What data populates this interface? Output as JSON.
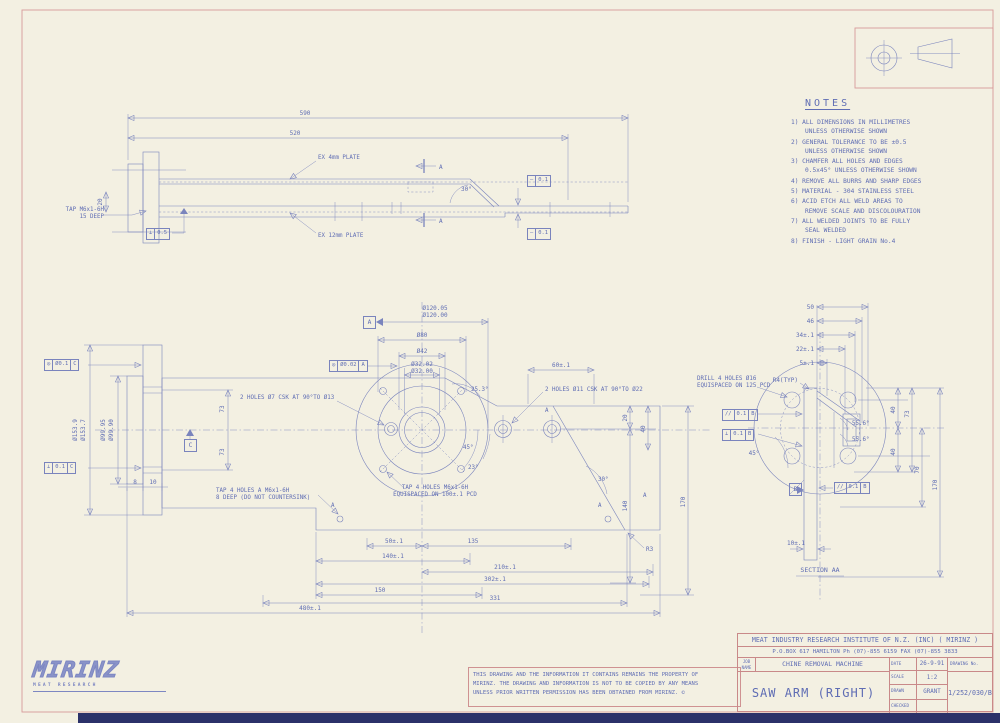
{
  "colors": {
    "paper": "#f3f0e2",
    "ink": "#7a84bd",
    "red": "#cf9292",
    "text": "#5f6db4",
    "dark_bar": "#2b3169"
  },
  "notes": {
    "title": "NOTES",
    "items": [
      "1) ALL DIMENSIONS IN MILLIMETRES\nUNLESS OTHERWISE SHOWN",
      "2) GENERAL TOLERANCE TO BE ±0.5\nUNLESS OTHERWISE SHOWN",
      "3) CHAMFER ALL HOLES AND EDGES\n0.5x45° UNLESS OTHERWISE SHOWN",
      "4) REMOVE ALL BURRS AND SHARP EDGES",
      "5) MATERIAL - 304 STAINLESS STEEL",
      "6) ACID ETCH ALL WELD AREAS TO\nREMOVE SCALE AND DISCOLOURATION",
      "7) ALL WELDED JOINTS TO BE FULLY\nSEAL WELDED",
      "8) FINISH - LIGHT GRAIN No.4"
    ]
  },
  "top_view": {
    "d590": "590",
    "d520": "520",
    "d20": "20",
    "ex4": "EX 4mm PLATE",
    "ex12": "EX 12mm PLATE",
    "tap": "TAP M6x1-6H\n15 DEEP",
    "sec_a1": "A",
    "sec_a2": "A",
    "ang30": "30°",
    "fcf_perp": {
      "sym": "⊥",
      "val": "0.5"
    },
    "fcf_str1": {
      "sym": "–",
      "val": "0.1"
    },
    "fcf_str2": {
      "sym": "–",
      "val": "0.1"
    }
  },
  "main_view": {
    "dia120_a": "Ø120.05",
    "dia120_b": "Ø120.00",
    "dia80": "Ø80",
    "dia42": "Ø42",
    "dia32_a": "Ø32.02",
    "dia32_b": "Ø32.00",
    "datum_a": "A",
    "datum_c": "C",
    "fcf_conc_hub": {
      "sym": "◎",
      "val": "Ø0.02",
      "ref": "A"
    },
    "fcf_conc_flange": {
      "sym": "◎",
      "val": "Ø0.1",
      "ref": "C"
    },
    "fcf_perp_flange": {
      "sym": "⊥",
      "val": "0.1",
      "ref": "C"
    },
    "dia153_a": "Ø153.9",
    "dia153_b": "Ø153.7",
    "dia99_a": "Ø99.95",
    "dia99_b": "Ø99.90",
    "d73a": "73",
    "d73b": "73",
    "holes7": "2 HOLES Ø7 CSK AT 90°TO Ø13",
    "holes11": "2 HOLES Ø11 CSK AT 90°TO Ø22",
    "tap_pcd": "TAP 4 HOLES M6x1-6H\nEQUISPACED ON 100±.1 PCD",
    "tap_deep": "TAP 4 HOLES A M6x1-6H\n8 DEEP (DO NOT COUNTERSINK)",
    "d60": "60±.1",
    "ang253": "25.3°",
    "ang45": "45°",
    "ang23": "23°",
    "ang30": "30°",
    "d20": "20",
    "d40": "40",
    "d140": "140",
    "d170": "170",
    "d50": "50±.1",
    "d135": "135",
    "d140t": "140±.1",
    "d210": "210±.1",
    "d302": "302±.1",
    "d331": "331",
    "d150": "150",
    "d480": "480±.1",
    "d8": "8",
    "d10": "10",
    "r3": "R3",
    "mark_a1": "A",
    "mark_a2": "A",
    "mark_a3": "A",
    "mark_a4": "A"
  },
  "section_view": {
    "d50": "50",
    "d46": "46",
    "d34": "34±.1",
    "d22": "22±.1",
    "d5": "5±.1",
    "r4": "R4(TYP)",
    "drill": "DRILL 4 HOLES Ø16\nEQUISPACED ON 125 PCD",
    "fcf_par": {
      "sym": "//",
      "val": "0.1",
      "ref": "B"
    },
    "fcf_perp": {
      "sym": "⊥",
      "val": "0.1",
      "ref": "B"
    },
    "fcf_par2": {
      "sym": "//",
      "val": "0.1",
      "ref": "B"
    },
    "datum_b": "B",
    "ang45": "45°",
    "ang556a": "55.6°",
    "ang556b": "55.6°",
    "d73": "73",
    "d40a": "40",
    "d40b": "40",
    "d70": "70",
    "d170": "170",
    "d10": "10±.1",
    "label": "SECTION AA"
  },
  "logo": {
    "name": "MIRINZ",
    "tagline": "MEAT RESEARCH"
  },
  "disclaimer": {
    "text": "THIS DRAWING AND THE INFORMATION IT CONTAINS REMAINS THE PROPERTY OF\nMIRINZ. THE DRAWING AND INFORMATION IS NOT TO BE COPIED BY ANY MEANS\nUNLESS PRIOR WRITTEN PERMISSION HAS BEEN OBTAINED FROM MIRINZ.  ©"
  },
  "title_block": {
    "company": "MEAT INDUSTRY RESEARCH INSTITUTE OF N.Z. (INC) ( MIRINZ )",
    "address": "P.O.BOX 617 HAMILTON   Ph (07)-855 6159   FAX (07)-855 3833",
    "job_label": "JOB\nNAME",
    "job_name": "CHINE REMOVAL MACHINE",
    "date_label": "DATE",
    "date": "26-9-91",
    "scale_label": "SCALE",
    "scale": "1:2",
    "drawn_label": "DRAWN",
    "drawn": "GRANT",
    "checked_label": "CHECKED",
    "checked": "",
    "drawing_no_label": "DRAWING No.",
    "drawing_no": "1/252/030/B",
    "title": "SAW ARM (RIGHT)"
  }
}
